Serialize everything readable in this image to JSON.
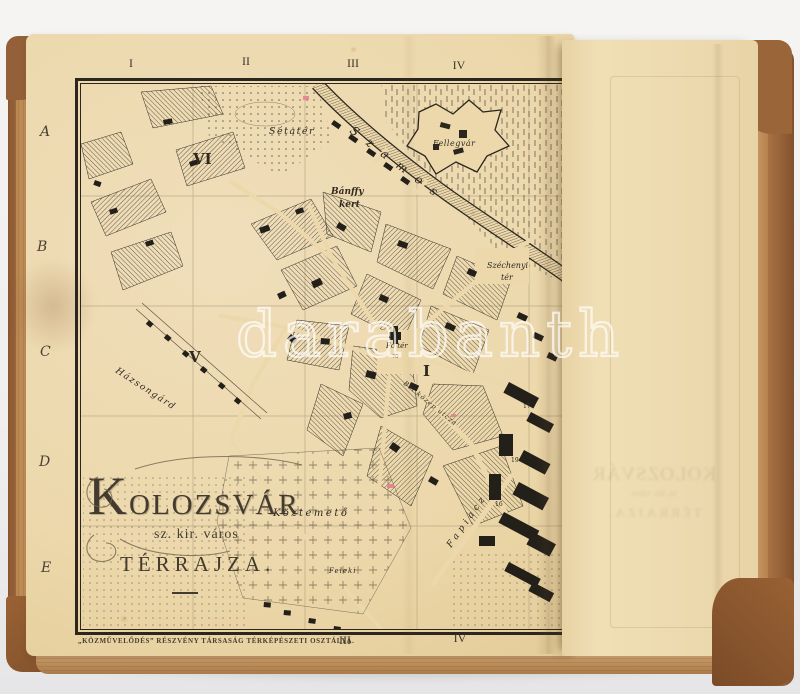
{
  "meta": {
    "description": "Photograph of an antique book opened to a fold-out 19th-century town plan of Kolozsvár"
  },
  "colors": {
    "paper_cream": "#ecd8ab",
    "overlay_page": "#efddb4",
    "map_ink": "#2b261e",
    "leather_brown": "#9a6538",
    "page_edge_tan": "#cf9f6a",
    "watermark_white": "#ffffff",
    "photo_background": "#f2f1ef"
  },
  "watermark": {
    "text": "darabanth"
  },
  "map": {
    "title": {
      "city": "KOLOZSVÁR",
      "subtitle": "sz. kir. város",
      "type_line": "TÉRRAJZA."
    },
    "imprint": "„KÖZMŰVELŐDÉS” RÉSZVÉNY TÁRSASÁG TÉRKÉPÉSZETI OSZTÁLYA.",
    "grid": {
      "top": [
        "I",
        "II",
        "III",
        "IV"
      ],
      "bottom": [
        "III",
        "IV"
      ],
      "rows": [
        "A",
        "B",
        "C",
        "D",
        "E"
      ]
    },
    "labels": {
      "setater": "Sétatér",
      "district_vi": "VI",
      "banffy_line1": "Bánffy",
      "banffy_line2": "kert",
      "fellegvar": "Fellegvár",
      "szamos": "Szamos",
      "szechenyi_line1": "Széchenyi",
      "szechenyi_line2": "tér",
      "fo_ter": "Fő tér",
      "fo_ter_number": "70",
      "district_i": "I",
      "district_v": "V",
      "hazsongard": "Házsongárd",
      "koztemeto": "Köztemető",
      "feleki": "Feleki",
      "fapiacz": "Fapiacz",
      "bel_kozep_utcza": "Bel közép utcza",
      "building_17": "17",
      "building_19": "19",
      "building_16": "16"
    }
  }
}
